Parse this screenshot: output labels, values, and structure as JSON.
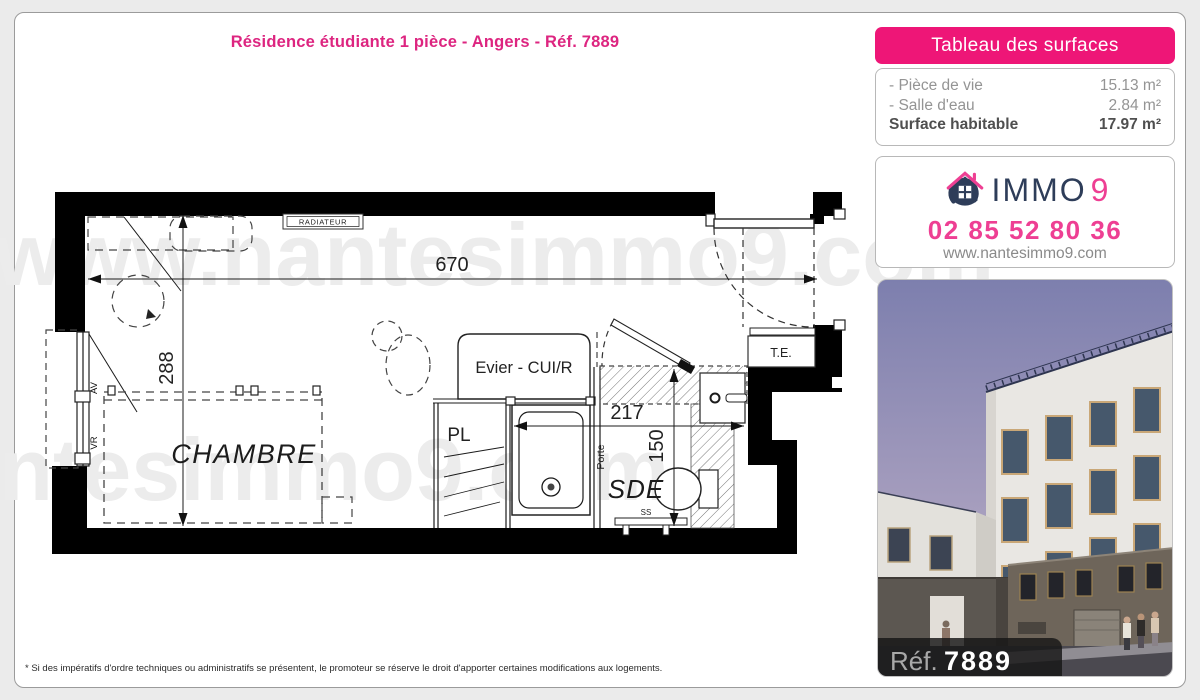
{
  "colors": {
    "accent": "#ee1677",
    "title_pink": "#dd2580",
    "phone_pink": "#ee3f93",
    "navy": "#2e3d59",
    "page_bg": "#ebebeb"
  },
  "header": {
    "title": "Résidence étudiante 1 pièce - Angers - Réf. 7889"
  },
  "surface_table": {
    "title": "Tableau des surfaces",
    "rows": [
      {
        "label": "- Pièce de vie",
        "value": "15.13 m²"
      },
      {
        "label": "- Salle d'eau",
        "value": "2.84 m²"
      }
    ],
    "total_label": "Surface habitable",
    "total_value": "17.97 m²"
  },
  "agency": {
    "logo_text": "IMMO",
    "logo_digit": "9",
    "phone": "02 85 52 80 36",
    "website": "www.nantesimmo9.com"
  },
  "floor_plan": {
    "watermark": "www.nantesimmo9.com",
    "room_labels": {
      "chambre": "CHAMBRE",
      "sde": "SDE"
    },
    "annotations": {
      "radiateur": "RADIATEUR",
      "evier": "Evier - CUI/R",
      "pl": "PL",
      "porte": "Porte",
      "te": "T.E.",
      "ss": "SS",
      "av": "AV",
      "vr": "VR"
    },
    "dimensions": {
      "total_width": "670",
      "total_depth": "288",
      "sde_width": "217",
      "sde_depth": "150"
    }
  },
  "photo": {
    "ref_label": "Réf.",
    "ref_value": "7889"
  },
  "footnote": "* Si des impératifs d'ordre techniques ou administratifs se présentent, le promoteur se réserve le droit d'apporter certaines modifications aux logements."
}
